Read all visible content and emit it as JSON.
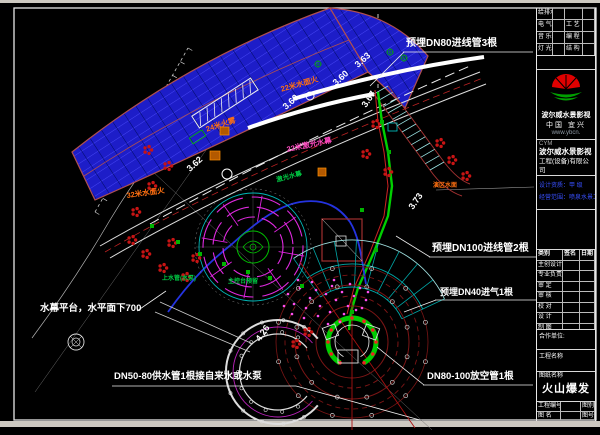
{
  "drawing": {
    "annotations": {
      "dn80_conduit": "预埋DN80进线管3根",
      "dn100_conduit": "预埋DN100进线管2根",
      "dn40_air": "预埋DN40进气1根",
      "drain_pipe": "DN80-100放空管1根",
      "supply_pipe": "DN50-80供水管1根接自来水或水泵",
      "curtain_platform": "水幕平台，水平面下700"
    },
    "features": {
      "fire_mist": "24米火雾",
      "laser_curtain_22m": "22米激光水幕",
      "surface_fire_32m": "32米水面火",
      "surface_fire_22m": "22米水面火",
      "laser_curtain": "激光水幕",
      "stage_water": "演区水面",
      "water_supply": "上水管(水泵)",
      "console": "主控台预留"
    },
    "elevations": [
      "3.60",
      "3.60",
      "3.63",
      "3.62",
      "3.67",
      "3.73",
      "4.26"
    ]
  },
  "titleblock": {
    "discipline_rows": [
      {
        "l": "给排水",
        "r": ""
      },
      {
        "l": "电 气",
        "r": "工 艺"
      },
      {
        "l": "音 乐",
        "r": "编 程"
      },
      {
        "l": "灯 光",
        "r": "结 构"
      }
    ],
    "brand": {
      "name": "波尔威水景影视",
      "region": "中国 宜兴",
      "site": "www.ybcn."
    },
    "company": {
      "tag": "CYM",
      "line1": "波尔威水景影视",
      "line2": "工程(设备)有限公司"
    },
    "notes": [
      "设计资质：甲 级",
      "经营范围：喷泉水景工程"
    ],
    "sign_table": {
      "h1": "类别",
      "h2": "签名",
      "h3": "日期",
      "rows": [
        "主创设计",
        "专业负责",
        "审 定",
        "审 核",
        "校 对",
        "设 计",
        "制 图"
      ]
    },
    "partner_label": "合作单位:",
    "project_label": "工程名称",
    "sheet_label": "图纸名称",
    "sheet_name": "火山爆发",
    "footer": {
      "no_label": "工程编号",
      "no_right": "图别",
      "name_label": "图 名",
      "name_right": "图号"
    }
  }
}
